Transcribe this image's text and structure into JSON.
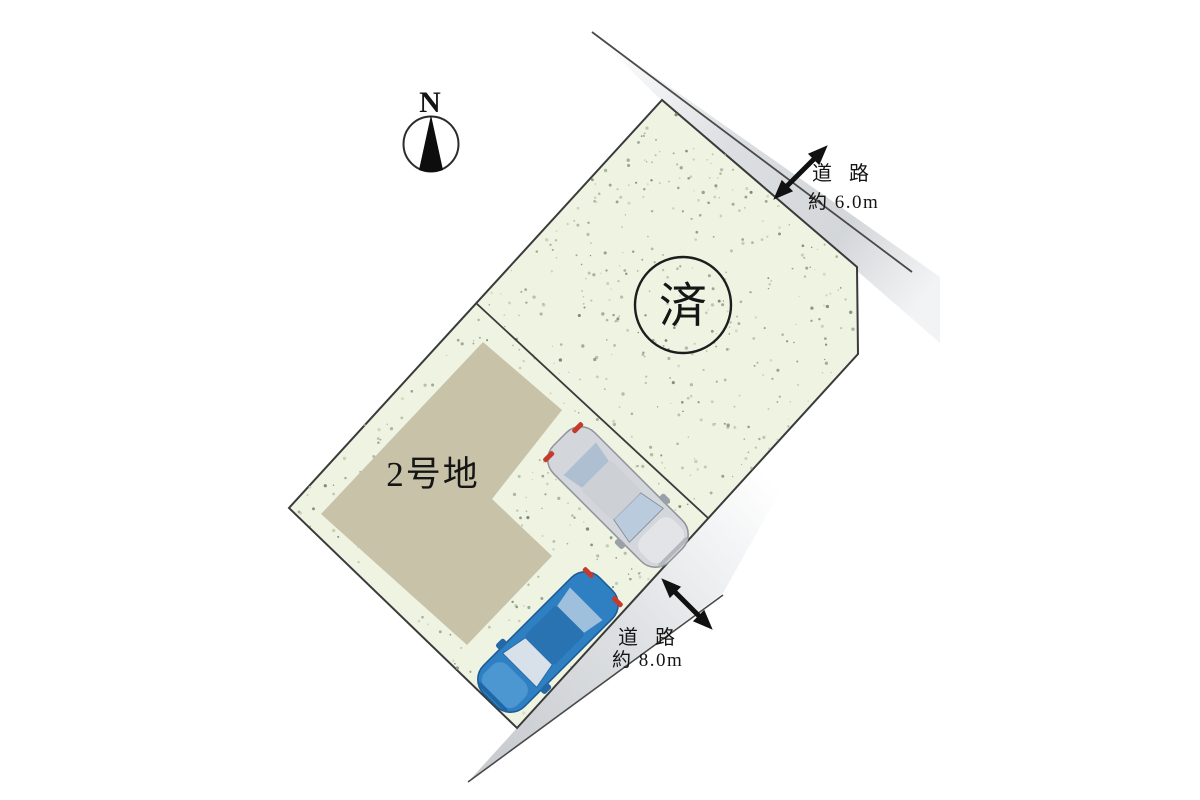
{
  "compass": {
    "north_label": "N"
  },
  "lots": {
    "sold_lot": {
      "status_label": "済"
    },
    "lot2": {
      "name_label": "2号地"
    }
  },
  "roads": {
    "northeast": {
      "label": "道路",
      "width_label": "約 6.0m"
    },
    "southeast": {
      "label": "道路",
      "width_label": "約 8.0m"
    }
  },
  "cars": {
    "silver": {
      "body_color": "#d3d6da",
      "glass_color": "#b9cbdd",
      "roof_color": "#cdd0d5"
    },
    "blue": {
      "body_color": "#2e80c3",
      "glass_color": "#d8e0e9",
      "roof_color": "#2a73b2"
    }
  },
  "colors": {
    "canvas_bg": "#ffffff",
    "plot_fill": "#eef3e2",
    "plot_stroke": "#3a3a3a",
    "building_fill": "#c8c2a9",
    "road_gray": "#d6d8db",
    "arrow_black": "#111111",
    "taillight_red": "#c43b2e",
    "stipple_dots": [
      "#aeb9a0",
      "#8d9c82",
      "#c3ccb4",
      "#76866c"
    ]
  }
}
